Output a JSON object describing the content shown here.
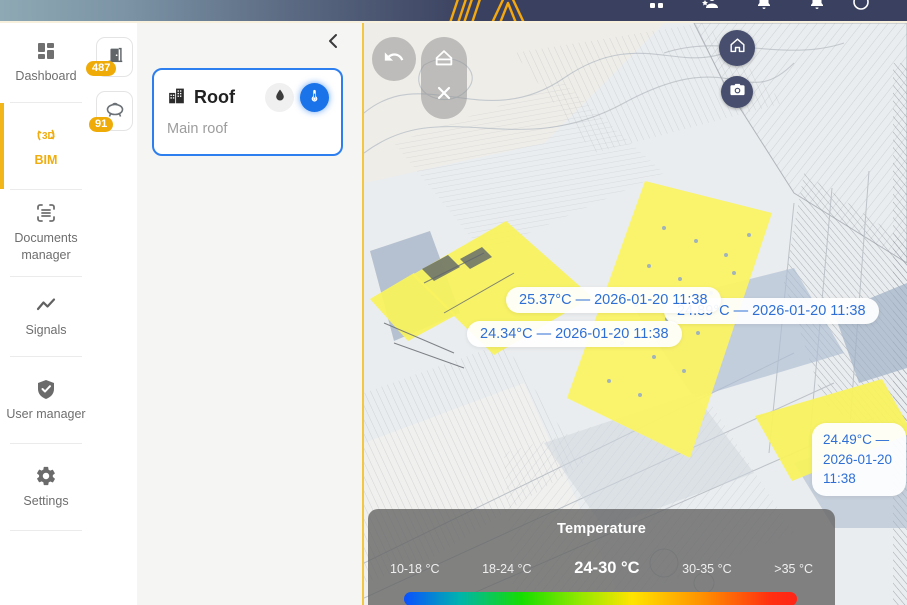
{
  "topbar": {
    "brand_icon": "brand-logo-slashes",
    "icon_names": [
      "apps-icon",
      "user-star-icon",
      "bell-icon",
      "notifications-icon",
      "account-icon"
    ]
  },
  "sidebar": {
    "items": [
      {
        "label": "Dashboard",
        "icon": "dashboard-icon",
        "active": false
      },
      {
        "label": "BIM",
        "icon": "bim-3d-icon",
        "active": true
      },
      {
        "label": "Documents manager",
        "icon": "documents-icon",
        "active": false
      },
      {
        "label": "Signals",
        "icon": "signals-icon",
        "active": false
      },
      {
        "label": "User manager",
        "icon": "user-manager-icon",
        "active": false
      },
      {
        "label": "Settings",
        "icon": "settings-icon",
        "active": false
      }
    ]
  },
  "asset_tabs": [
    {
      "icon": "door-icon",
      "badge": "487"
    },
    {
      "icon": "tank-icon",
      "badge": "91"
    }
  ],
  "panel": {
    "card": {
      "title": "Roof",
      "subtitle": "Main roof",
      "icon": "building-icon",
      "toggles": [
        {
          "icon": "water-drop-icon",
          "active": false
        },
        {
          "icon": "thermometer-icon",
          "active": true
        }
      ]
    }
  },
  "viewer": {
    "toolbar_icons": [
      "undo-icon",
      "roof-icon",
      "section-cut-icon"
    ],
    "control_icons": [
      "home-icon",
      "camera-icon"
    ],
    "labels": [
      {
        "text": "25.37°C — 2026-01-20 11:38"
      },
      {
        "text": "24.89°C — 2026-01-20 11:38"
      },
      {
        "text": "24.34°C — 2026-01-20 11:38"
      },
      {
        "text": "24.49°C — 2026-01-20 11:38"
      }
    ],
    "legend": {
      "title": "Temperature",
      "ranges": [
        "10-18 °C",
        "18-24 °C",
        "24-30 °C",
        "30-35 °C",
        ">35 °C"
      ],
      "active_range": "24-30 °C",
      "gradient_colors": [
        "#0a50ff",
        "#00b3ae",
        "#16dd00",
        "#ffe400",
        "#ff9000",
        "#ff2418"
      ]
    }
  },
  "colors": {
    "accent_yellow": "#f0ad0f",
    "badge_yellow": "#efac08",
    "active_blue": "#1a73e8",
    "card_border_blue": "#2d7ff0",
    "label_blue": "#2e6fd6",
    "topbar_dark": "#3a4160",
    "roof_highlight_yellow": "#f8f25e"
  }
}
